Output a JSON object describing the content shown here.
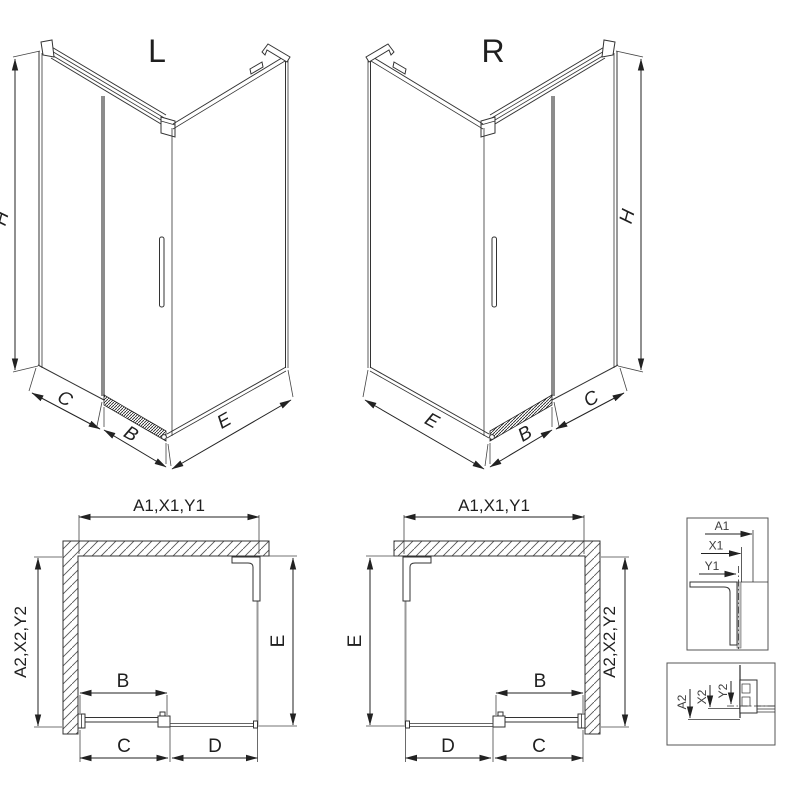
{
  "drawing": {
    "variant_left": {
      "label": "L",
      "dims": {
        "height": "H",
        "fixed_panel": "C",
        "door": "B",
        "side_panel": "E"
      }
    },
    "variant_right": {
      "label": "R",
      "dims": {
        "height": "H",
        "fixed_panel": "C",
        "door": "B",
        "side_panel": "E"
      }
    },
    "plan_left": {
      "dims": {
        "width_top": "A1,X1,Y1",
        "depth_side": "A2,X2,Y2",
        "side_panel": "E",
        "door": "B",
        "fixed_panel": "C",
        "opening": "D"
      }
    },
    "plan_right": {
      "dims": {
        "width_top": "A1,X1,Y1",
        "depth_side": "A2,X2,Y2",
        "side_panel": "E",
        "door": "B",
        "fixed_panel": "C",
        "opening": "D"
      }
    },
    "detail_width": {
      "dims": {
        "a1": "A1",
        "x1": "X1",
        "y1": "Y1"
      }
    },
    "detail_depth": {
      "dims": {
        "a2": "A2",
        "x2": "X2",
        "y2": "Y2"
      }
    }
  }
}
